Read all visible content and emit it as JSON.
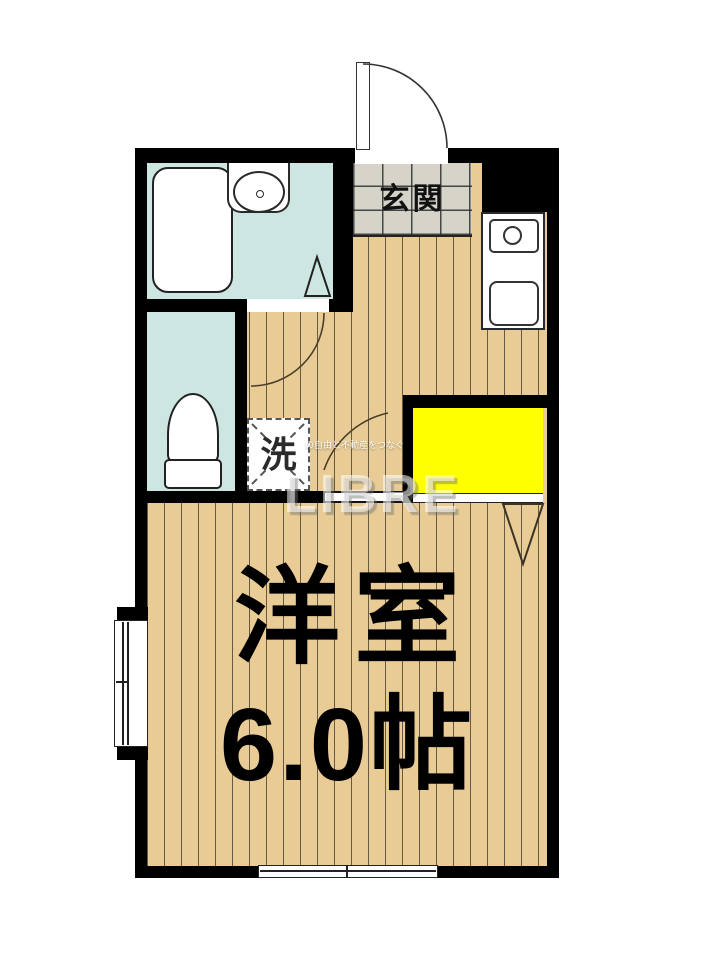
{
  "floorplan": {
    "labels": {
      "entrance": "玄関",
      "laundry": "洗",
      "main_room_name": "洋室",
      "main_room_size": "6.0帖"
    },
    "watermark": {
      "brand": "LIBRE",
      "tagline": "の自由と不動産をつなぐ"
    },
    "fixtures": [
      "bathtub",
      "vanity-sink",
      "toilet",
      "washing-machine-space",
      "stove-burner",
      "kitchen-sink",
      "closet",
      "entrance-door",
      "sliding-window-bottom",
      "window-left"
    ],
    "colors": {
      "wall": "#000000",
      "flooring": "#e9cc95",
      "wet_area": "#cde6e2",
      "entrance_tile": "#d6d3c8",
      "closet": "#ffff00",
      "fixture_outline": "#222222"
    }
  }
}
